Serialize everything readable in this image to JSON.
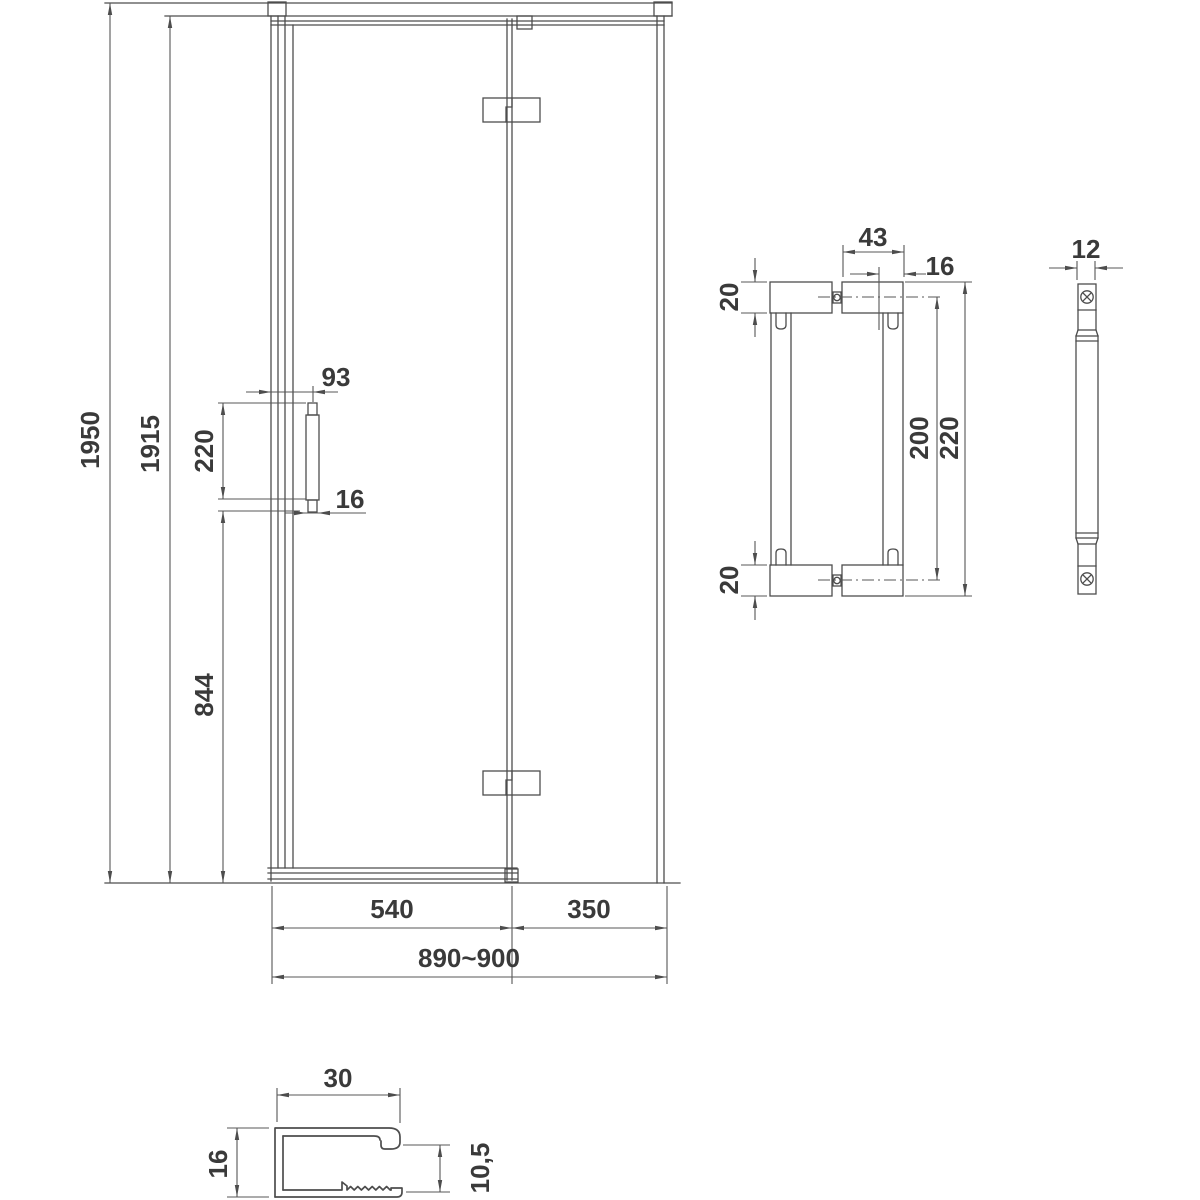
{
  "colors": {
    "line": "#4d4d4d",
    "dimension_line": "#575757",
    "text": "#3a3a3a",
    "background": "#ffffff"
  },
  "door_view": {
    "dims": {
      "total_height": "1950",
      "glass_height": "1915",
      "handle_length": "220",
      "handle_offset": "93",
      "handle_width": "16",
      "handle_to_floor": "844",
      "door_width": "540",
      "panel_width": "350",
      "overall_width": "890~900"
    }
  },
  "handle_front_view": {
    "dims": {
      "mount_width": "43",
      "bar_offset": "16",
      "mount_height_top": "20",
      "mount_height_bottom": "20",
      "hole_spacing": "200",
      "overall_length": "220"
    }
  },
  "handle_side_view": {
    "dims": {
      "thickness": "12"
    }
  },
  "profile_view": {
    "dims": {
      "width": "30",
      "height": "16",
      "inner_height": "10,5"
    }
  }
}
